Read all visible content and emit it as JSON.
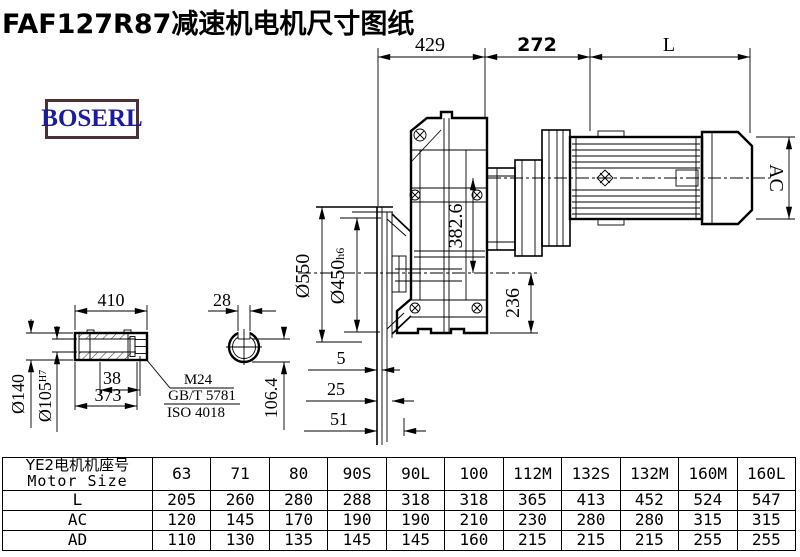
{
  "title": "FAF127R87减速机电机尺寸图纸",
  "logo": {
    "text": "BOSERL"
  },
  "colors": {
    "line": "#000000",
    "logo_text": "#1b1b9e",
    "logo_border": "#4b3135"
  },
  "dims": {
    "top429": "429",
    "top272": "272",
    "topL": "L",
    "d410": "410",
    "d38": "38",
    "d373": "373",
    "dia140": "Ø140",
    "dia105": "Ø105",
    "dia105_tol": "H7",
    "bolt": "M24",
    "std1": "GB/T 5781",
    "std2": "ISO 4018",
    "d28": "28",
    "d106": "106.4",
    "dia550": "Ø550",
    "dia450": "Ø450",
    "dia450_tol": "h6",
    "d382": "382.6",
    "d236": "236",
    "d5": "5",
    "d25": "25",
    "d51": "51",
    "ac": "AC"
  },
  "table": {
    "header_cn": "YE2电机机座号",
    "header_en": "Motor Size",
    "sizes": [
      "63",
      "71",
      "80",
      "90S",
      "90L",
      "100",
      "112M",
      "132S",
      "132M",
      "160M",
      "160L"
    ],
    "rows": [
      {
        "label": "L",
        "values": [
          "205",
          "260",
          "280",
          "288",
          "318",
          "318",
          "365",
          "413",
          "452",
          "524",
          "547"
        ]
      },
      {
        "label": "AC",
        "values": [
          "120",
          "145",
          "170",
          "190",
          "190",
          "210",
          "230",
          "280",
          "280",
          "315",
          "315"
        ]
      },
      {
        "label": "AD",
        "values": [
          "110",
          "130",
          "135",
          "145",
          "145",
          "160",
          "215",
          "215",
          "215",
          "255",
          "255"
        ]
      }
    ]
  }
}
